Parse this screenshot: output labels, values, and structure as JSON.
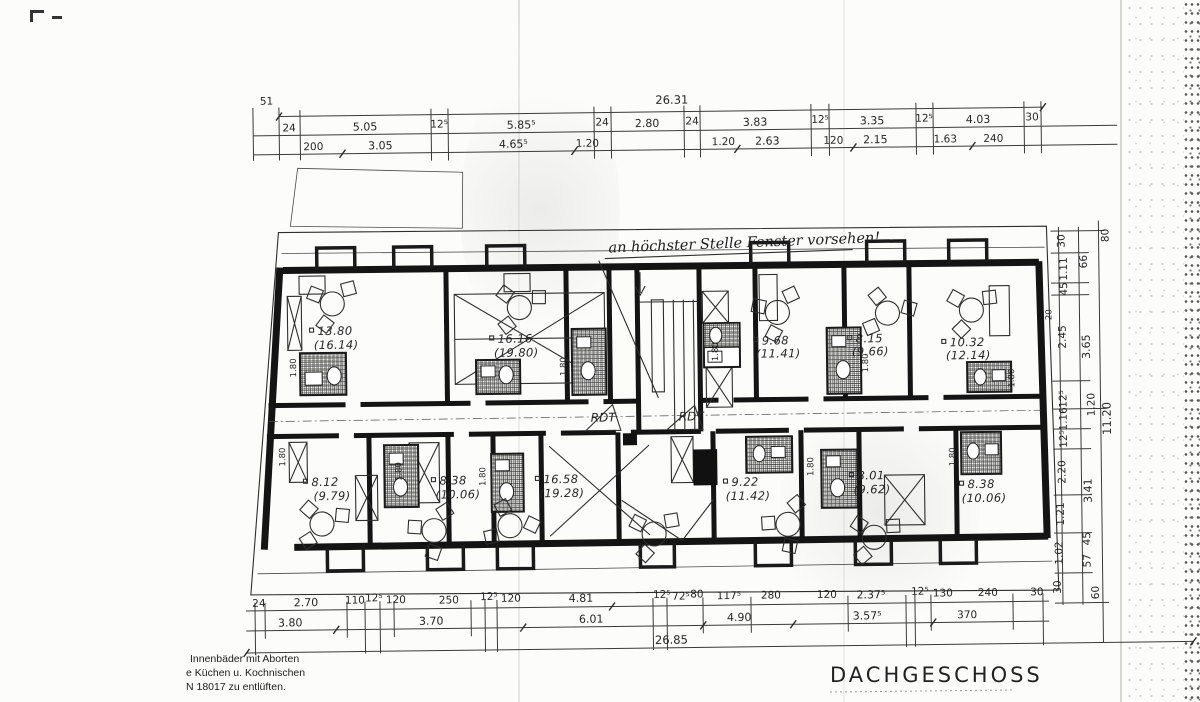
{
  "title": "DACHGESCHOSS",
  "note": "an höchster Stelle Fenster vorsehen!",
  "corridor_labels": [
    "RDT",
    "RDT"
  ],
  "legend": {
    "line1": "Innenbäder mit Aborten",
    "line2": "e Küchen u. Kochnischen",
    "line3": "N 18017 zu entlüften."
  },
  "dims": {
    "left_offset": "51",
    "top_total": "26.31",
    "top_row_a": [
      "24",
      "5.05",
      "12⁵",
      "5.85⁵",
      "24",
      "2.80",
      "24",
      "3.83",
      "12⁵",
      "3.35",
      "12⁵",
      "4.03",
      "30"
    ],
    "top_row_b": [
      "200",
      "3.05",
      "4.65⁵",
      "1.20",
      "1.20",
      "2.63",
      "120",
      "2.15",
      "1.63",
      "240"
    ],
    "bottom_row_a": [
      "24",
      "2.70",
      "110",
      "12⁵",
      "120",
      "250",
      "12⁵",
      "120",
      "4.81",
      "12⁵",
      "72⁵",
      "80",
      "117⁵",
      "280",
      "120",
      "2.37⁵",
      "12⁵",
      "130",
      "240",
      "30"
    ],
    "bottom_row_b": [
      "3.80",
      "3.70",
      "6.01",
      "4.90",
      "3.57⁵",
      "370"
    ],
    "bottom_total": "26.85",
    "right_top": "80",
    "right_total": "11.20",
    "wall_mark": "20",
    "right_col_a": [
      "30",
      "1.11",
      "45",
      "2.45",
      "12⁵",
      "1.16",
      "12⁵",
      "2.20",
      "1.21",
      "1.02",
      "30"
    ],
    "right_col_b": [
      "66",
      "3.65",
      "1.20",
      "3.41",
      "45",
      "57",
      "60"
    ]
  },
  "rooms": {
    "top": [
      {
        "a": "13.80",
        "b": "(16.14)"
      },
      {
        "a": "16.16",
        "b": "(19.80)"
      },
      {
        "a": "9.68",
        "b": "(11.41)"
      },
      {
        "a": "8.15",
        "b": "(9.66)"
      },
      {
        "a": "10.32",
        "b": "(12.14)"
      }
    ],
    "bottom": [
      {
        "a": "8.12",
        "b": "(9.79)"
      },
      {
        "a": "8.38",
        "b": "(10.06)"
      },
      {
        "a": "16.58",
        "b": "(19.28)"
      },
      {
        "a": "9.22",
        "b": "(11.42)"
      },
      {
        "a": "8.01",
        "b": "(9.62)"
      },
      {
        "a": "8.38",
        "b": "(10.06)"
      }
    ]
  },
  "bath_label": "1.80"
}
